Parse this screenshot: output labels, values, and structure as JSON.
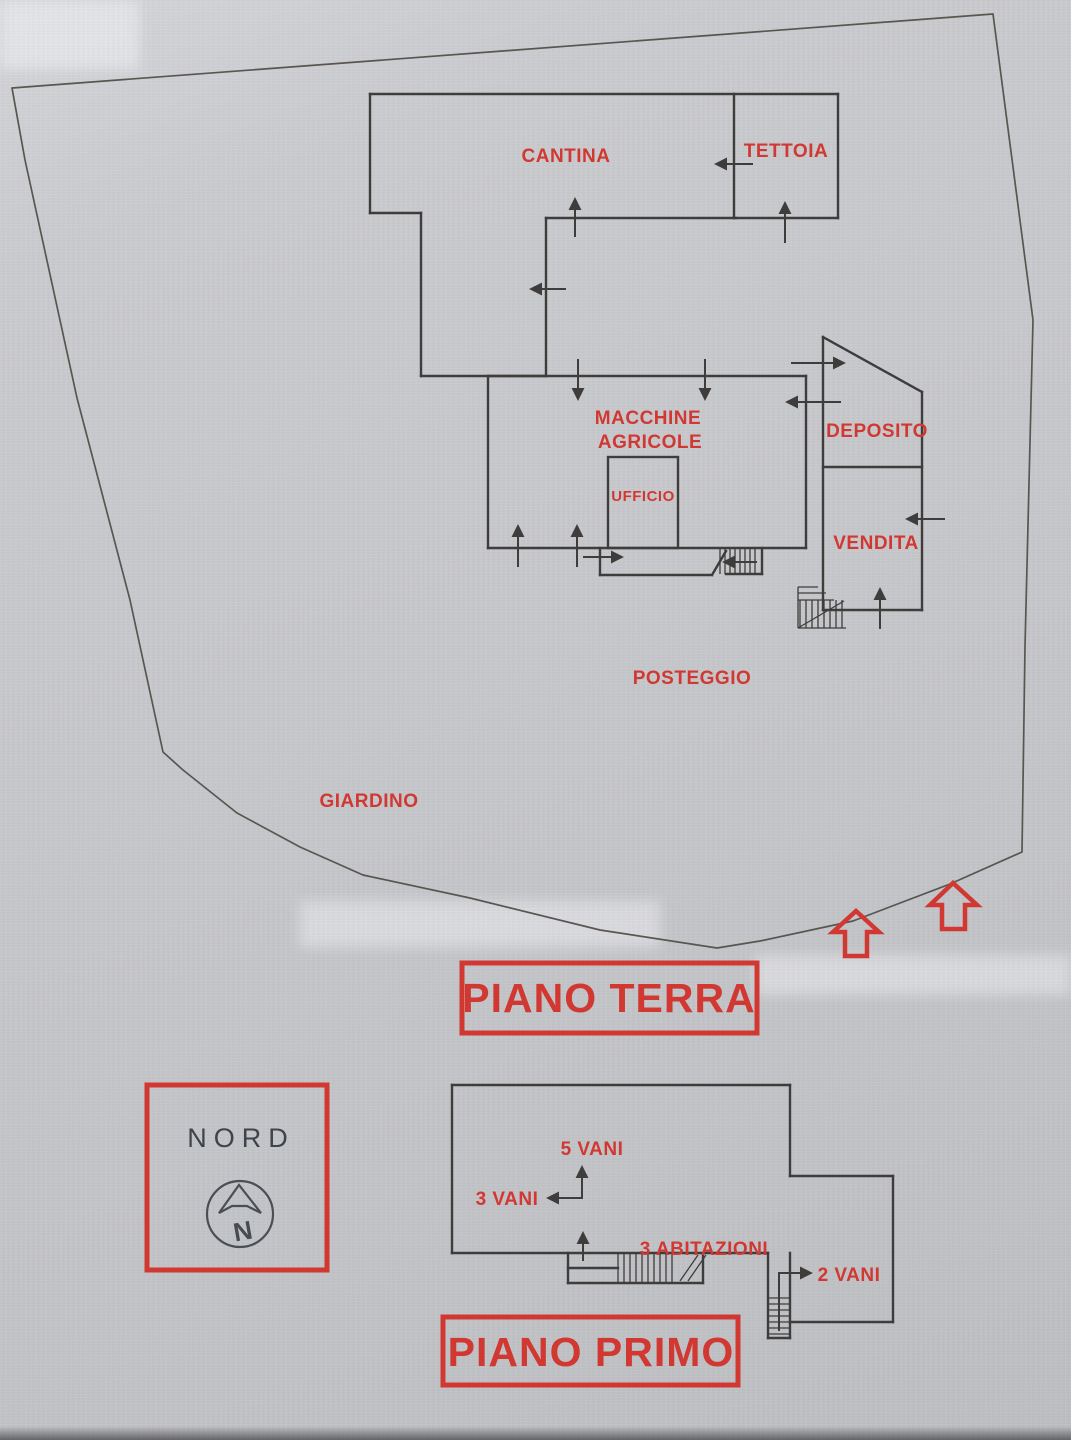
{
  "colors": {
    "paper": "#c8c9cd",
    "ink": "#3e3d3b",
    "red": "#d13832",
    "nord": "#3f434b"
  },
  "ground_floor": {
    "title": "PIANO TERRA",
    "rooms": {
      "cantina": "CANTINA",
      "tettoia": "TETTOIA",
      "macchine_line1": "MACCHINE",
      "macchine_line2": "AGRICOLE",
      "ufficio": "UFFICIO",
      "deposito": "DEPOSITO",
      "vendita": "VENDITA"
    },
    "outdoor": {
      "posteggio": "POSTEGGIO",
      "giardino": "GIARDINO"
    }
  },
  "compass": {
    "title": "NORD",
    "letter": "N"
  },
  "first_floor": {
    "title": "PIANO PRIMO",
    "annotations": {
      "vani5": "5 VANI",
      "vani3": "3 VANI",
      "abitazioni": "3 ABITAZIONI",
      "vani2": "2 VANI"
    }
  }
}
